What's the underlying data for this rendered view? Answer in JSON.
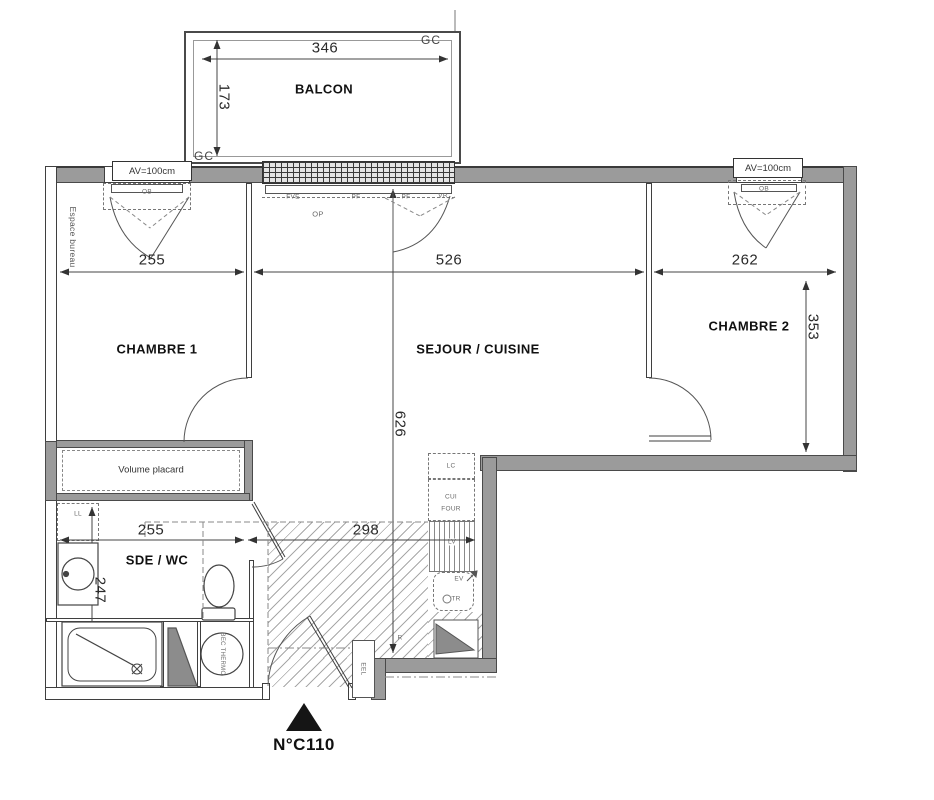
{
  "unit": {
    "number": "N°C110"
  },
  "rooms": {
    "balcon": "BALCON",
    "chambre1": "CHAMBRE 1",
    "sejour": "SEJOUR / CUISINE",
    "chambre2": "CHAMBRE 2",
    "sde": "SDE / WC"
  },
  "dimensions": {
    "balcony_width": "346",
    "balcony_depth": "173",
    "chambre1_width": "255",
    "sejour_width": "526",
    "chambre2_width": "262",
    "chambre2_depth": "353",
    "sejour_depth": "626",
    "sde_width": "255",
    "hall_width": "298",
    "sde_depth": "247"
  },
  "annotations": {
    "gc_top": "GC",
    "gc_bottom": "GC",
    "av_left": "AV=100cm",
    "av_right": "AV=100cm",
    "espace_bureau": "Espace bureau",
    "volume_placard": "Volume placard",
    "ll": "LL",
    "lc": "LC",
    "cui": "CUI",
    "four": "FOUR",
    "lv": "LV",
    "ev": "EV",
    "tr": "TR",
    "bec_thermo": "BEC THERMO",
    "eel": "EEL",
    "op": "OP",
    "fve": "FVE",
    "pf": "PF",
    "vr": "VR",
    "ob": "OB",
    "r": "R"
  },
  "colors": {
    "wall_fill": "#9b9b9b",
    "wall_line": "#4a4a4a",
    "thin_line": "#3f3f3f",
    "text": "#1f1f1f"
  }
}
